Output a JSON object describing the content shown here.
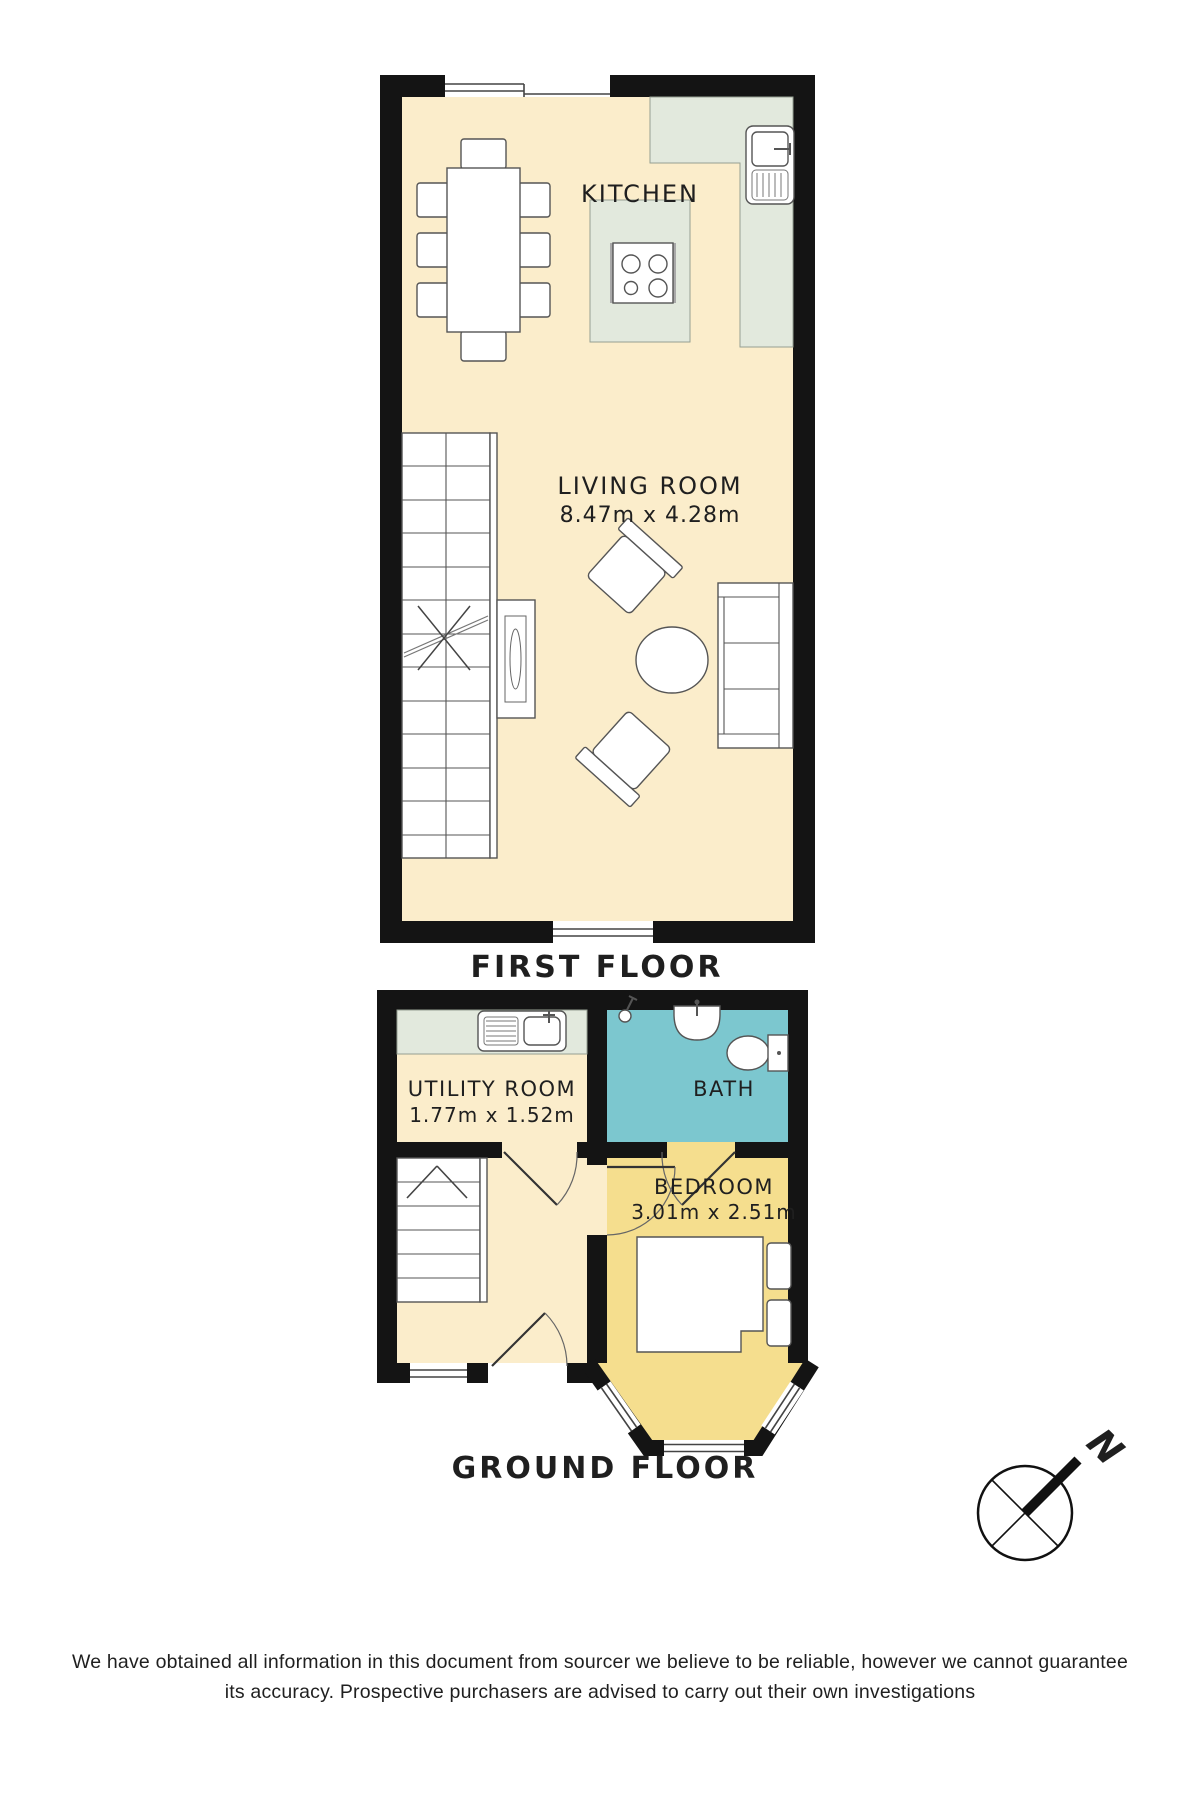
{
  "palette": {
    "wall": "#141414",
    "line": "#555555",
    "room_cream": "#FBEDCB",
    "counter_sage": "#E2E9DD",
    "bath_teal": "#7CC7CF",
    "bedroom_yellow": "#F5DE8E",
    "text": "#1f1f1f",
    "window_line": "#444444"
  },
  "first_floor": {
    "section_label": "FIRST FLOOR",
    "kitchen": {
      "name": "KITCHEN"
    },
    "living_room": {
      "name": "LIVING ROOM",
      "dimensions": "8.47m x 4.28m"
    },
    "furniture_icons": [
      "dining-table",
      "dining-chairs",
      "kitchen-worktop",
      "kitchen-island-hob",
      "kitchen-sink",
      "stairs",
      "console-table",
      "armchairs",
      "coffee-table",
      "sofa",
      "windows"
    ]
  },
  "ground_floor": {
    "section_label": "GROUND FLOOR",
    "utility_room": {
      "name": "UTILITY ROOM",
      "dimensions": "1.77m x 1.52m"
    },
    "bath": {
      "name": "BATH"
    },
    "bedroom": {
      "name": "BEDROOM",
      "dimensions": "3.01m x 2.51m"
    },
    "furniture_icons": [
      "utility-sink",
      "shower",
      "wash-basin",
      "toilet",
      "stairs",
      "entrance-door",
      "double-bed",
      "pillows",
      "bay-window"
    ]
  },
  "compass": {
    "label": "N"
  },
  "disclaimer": {
    "line1": "We have obtained all information in this document from sourcer we believe to be reliable, however we cannot guarantee",
    "line2": "its accuracy. Prospective purchasers are advised to carry out their own investigations"
  }
}
